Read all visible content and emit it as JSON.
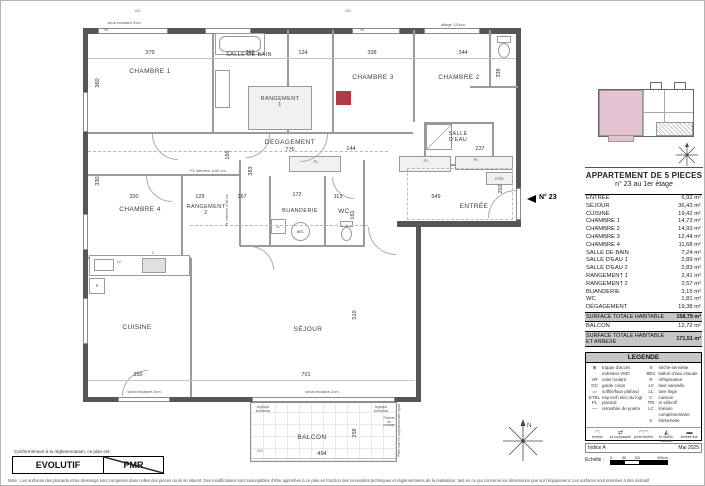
{
  "colors": {
    "wall": "#54565a",
    "marker_red": "#b13a49",
    "keyplan_pink": "#e4c3d3",
    "band_gray": "#c6c6c6"
  },
  "panel": {
    "title_line1": "APPARTEMENT DE 5 PIECES",
    "title_line2": "n° 23 au 1er étage",
    "surface_table": {
      "rows": [
        {
          "label": "ENTRÉE",
          "value": "6,92 m²"
        },
        {
          "label": "SÉJOUR",
          "value": "36,43 m²"
        },
        {
          "label": "CUISINE",
          "value": "19,42 m²"
        },
        {
          "label": "CHAMBRE 1",
          "value": "14,73 m²"
        },
        {
          "label": "CHAMBRE 2",
          "value": "14,93 m²"
        },
        {
          "label": "CHAMBRE 3",
          "value": "12,44 m²"
        },
        {
          "label": "CHAMBRE 4",
          "value": "11,68 m²"
        },
        {
          "label": "SALLE DE BAIN",
          "value": "7,24 m²"
        },
        {
          "label": "SALLE D'EAU 1",
          "value": "2,89 m²"
        },
        {
          "label": "SALLE D'EAU 2",
          "value": "2,83 m²"
        },
        {
          "label": "RANGEMENT 1",
          "value": "2,41 m²"
        },
        {
          "label": "RANGEMENT 2",
          "value": "2,57 m²"
        },
        {
          "label": "BUANDERIE",
          "value": "3,15 m²"
        },
        {
          "label": "WC",
          "value": "1,81 m²"
        },
        {
          "label": "DÉGAGEMENT",
          "value": "19,38 m²"
        }
      ],
      "total_habitable": {
        "label": "SURFACE TOTALE HABITABLE",
        "value": "158,79 m²"
      },
      "balcon": {
        "label": "BALCON",
        "value": "12,72 m²"
      },
      "total_annexe": {
        "label": "SURFACE TOTALE HABITABLE\nET ANNEXE",
        "value": "171,51 m²"
      }
    },
    "legend": {
      "title": "LEGENDE",
      "left": [
        {
          "sym": "⊞",
          "icon": "vmc-hatch-icon",
          "label": "trappe d'accès entretien VMC"
        },
        {
          "sym": "VR",
          "label": "volet roulant"
        },
        {
          "sym": "GC",
          "label": "garde corps"
        },
        {
          "sym": "▭",
          "icon": "soffit-icon",
          "label": "soffite/faux plafond"
        },
        {
          "sym": "ETEL",
          "label": "esp tech elec du logt"
        },
        {
          "sym": "PL",
          "label": "placard"
        },
        {
          "sym": "╌╌",
          "icon": "beam-line-icon",
          "label": "retombée de poutre"
        }
      ],
      "right": [
        {
          "sym": "≋",
          "icon": "towel-radiator-icon",
          "label": "sèche-serviette"
        },
        {
          "sym": "BEC",
          "label": "ballon d'eau chaude"
        },
        {
          "sym": "R",
          "label": "réfrigérateur"
        },
        {
          "sym": "LV",
          "label": "lave vaisselle"
        },
        {
          "sym": "LL",
          "label": "lave linge"
        },
        {
          "sym": "C",
          "label": "cuisson"
        },
        {
          "sym": "TRI",
          "label": "tri sélectif"
        },
        {
          "sym": "LC",
          "label": "linéaire complémentaire"
        },
        {
          "sym": "K",
          "label": "kitchenette"
        }
      ],
      "windows": [
        {
          "sym": "◠",
          "icon": "window-icon",
          "label": "fenêtre"
        },
        {
          "sym": "⇄",
          "icon": "sliding-window-icon",
          "label": "pf coulissante"
        },
        {
          "sym": "◠◠",
          "icon": "french-door-icon",
          "label": "porte fenêtre"
        },
        {
          "sym": "◭",
          "icon": "tilt-window-icon",
          "label": "fe oscillo-battante"
        },
        {
          "sym": "▬",
          "icon": "fixed-window-icon",
          "label": "fenêtre fixe"
        }
      ]
    },
    "indice": "Indice A",
    "date": "Mai 2025",
    "echelle_label": "Echelle :",
    "scale_ticks": {
      "t0": "0",
      "t50": "50",
      "t100": "100",
      "t200": "200cm"
    }
  },
  "plan": {
    "marker": "N° 23",
    "rooms": {
      "chambre1": "CHAMBRE 1",
      "salle_de_bain": "SALLE DE BAIN",
      "rangement1": "RANGEMENT\n1",
      "chambre3": "CHAMBRE 3",
      "chambre2": "CHAMBRE 2",
      "salle_deau1": "SALLE\nD'EAU",
      "degagement": "DEGAGEMENT",
      "chambre4": "CHAMBRE 4",
      "rangement2": "RANGEMENT\n2",
      "buanderie": "BUANDERIE",
      "wc": "WC",
      "entree": "ENTRÉE",
      "cuisine": "CUISINE",
      "sejour": "SÉJOUR",
      "balcon": "BALCON"
    },
    "dims": {
      "d379": "379",
      "d262": "262",
      "d124": "124",
      "d338": "338",
      "d344": "344",
      "d776": "776",
      "d144": "144",
      "d237": "237",
      "d320": "320",
      "d129": "129",
      "d167": "167",
      "d172": "172",
      "d113": "113",
      "d549": "549",
      "d350": "350",
      "d701": "701",
      "d494": "494",
      "v360": "360",
      "v330": "330",
      "v339": "339",
      "v165": "165",
      "v383": "383",
      "v161": "161",
      "v202": "202",
      "v510": "510",
      "v258": "258"
    },
    "notes": {
      "gc1": "GC",
      "gc2": "GC",
      "gc3": "GC",
      "vr1": "VR",
      "vr2": "VR",
      "seuil1": "seuil encastré 2cm",
      "seuil2": "seuil encastré 2cm",
      "seuil3": "seuil encastré 2cm",
      "allege": "allège 120cm",
      "pl_int1": "PL intérieur à 60 cm",
      "pl_int2": "PL intérieur à 60 cm",
      "pl1": "PL",
      "pl2": "PL",
      "pl3": "PL",
      "etel": "ETEL",
      "app1": "Applique\nlumineuse",
      "app2": "Applique\nlumineuse",
      "robinet": "Robinet\nde\npuisage",
      "parevue": "Pare-vue en polycarbonate rigide",
      "bec": "BEC",
      "ll": "LL",
      "r": "R",
      "lv": "LV",
      "c": "C"
    }
  },
  "footer": {
    "conformity": "Conformément à la réglementation, ce plan est:",
    "evolutif": "EVOLUTIF",
    "pmr": "PMR",
    "note": "Note : Les surfaces des placards et/ou dressings sont comprises dans celles des pièces où ils se situent. Des modifications sont susceptibles d'être apportées à ce plan en fonction des nécessités techniques et réglementaires de la réalisation, tant en ce qui concerne les dimensions que sur l'équipement. Les surfaces sont données à titre indicatif."
  }
}
